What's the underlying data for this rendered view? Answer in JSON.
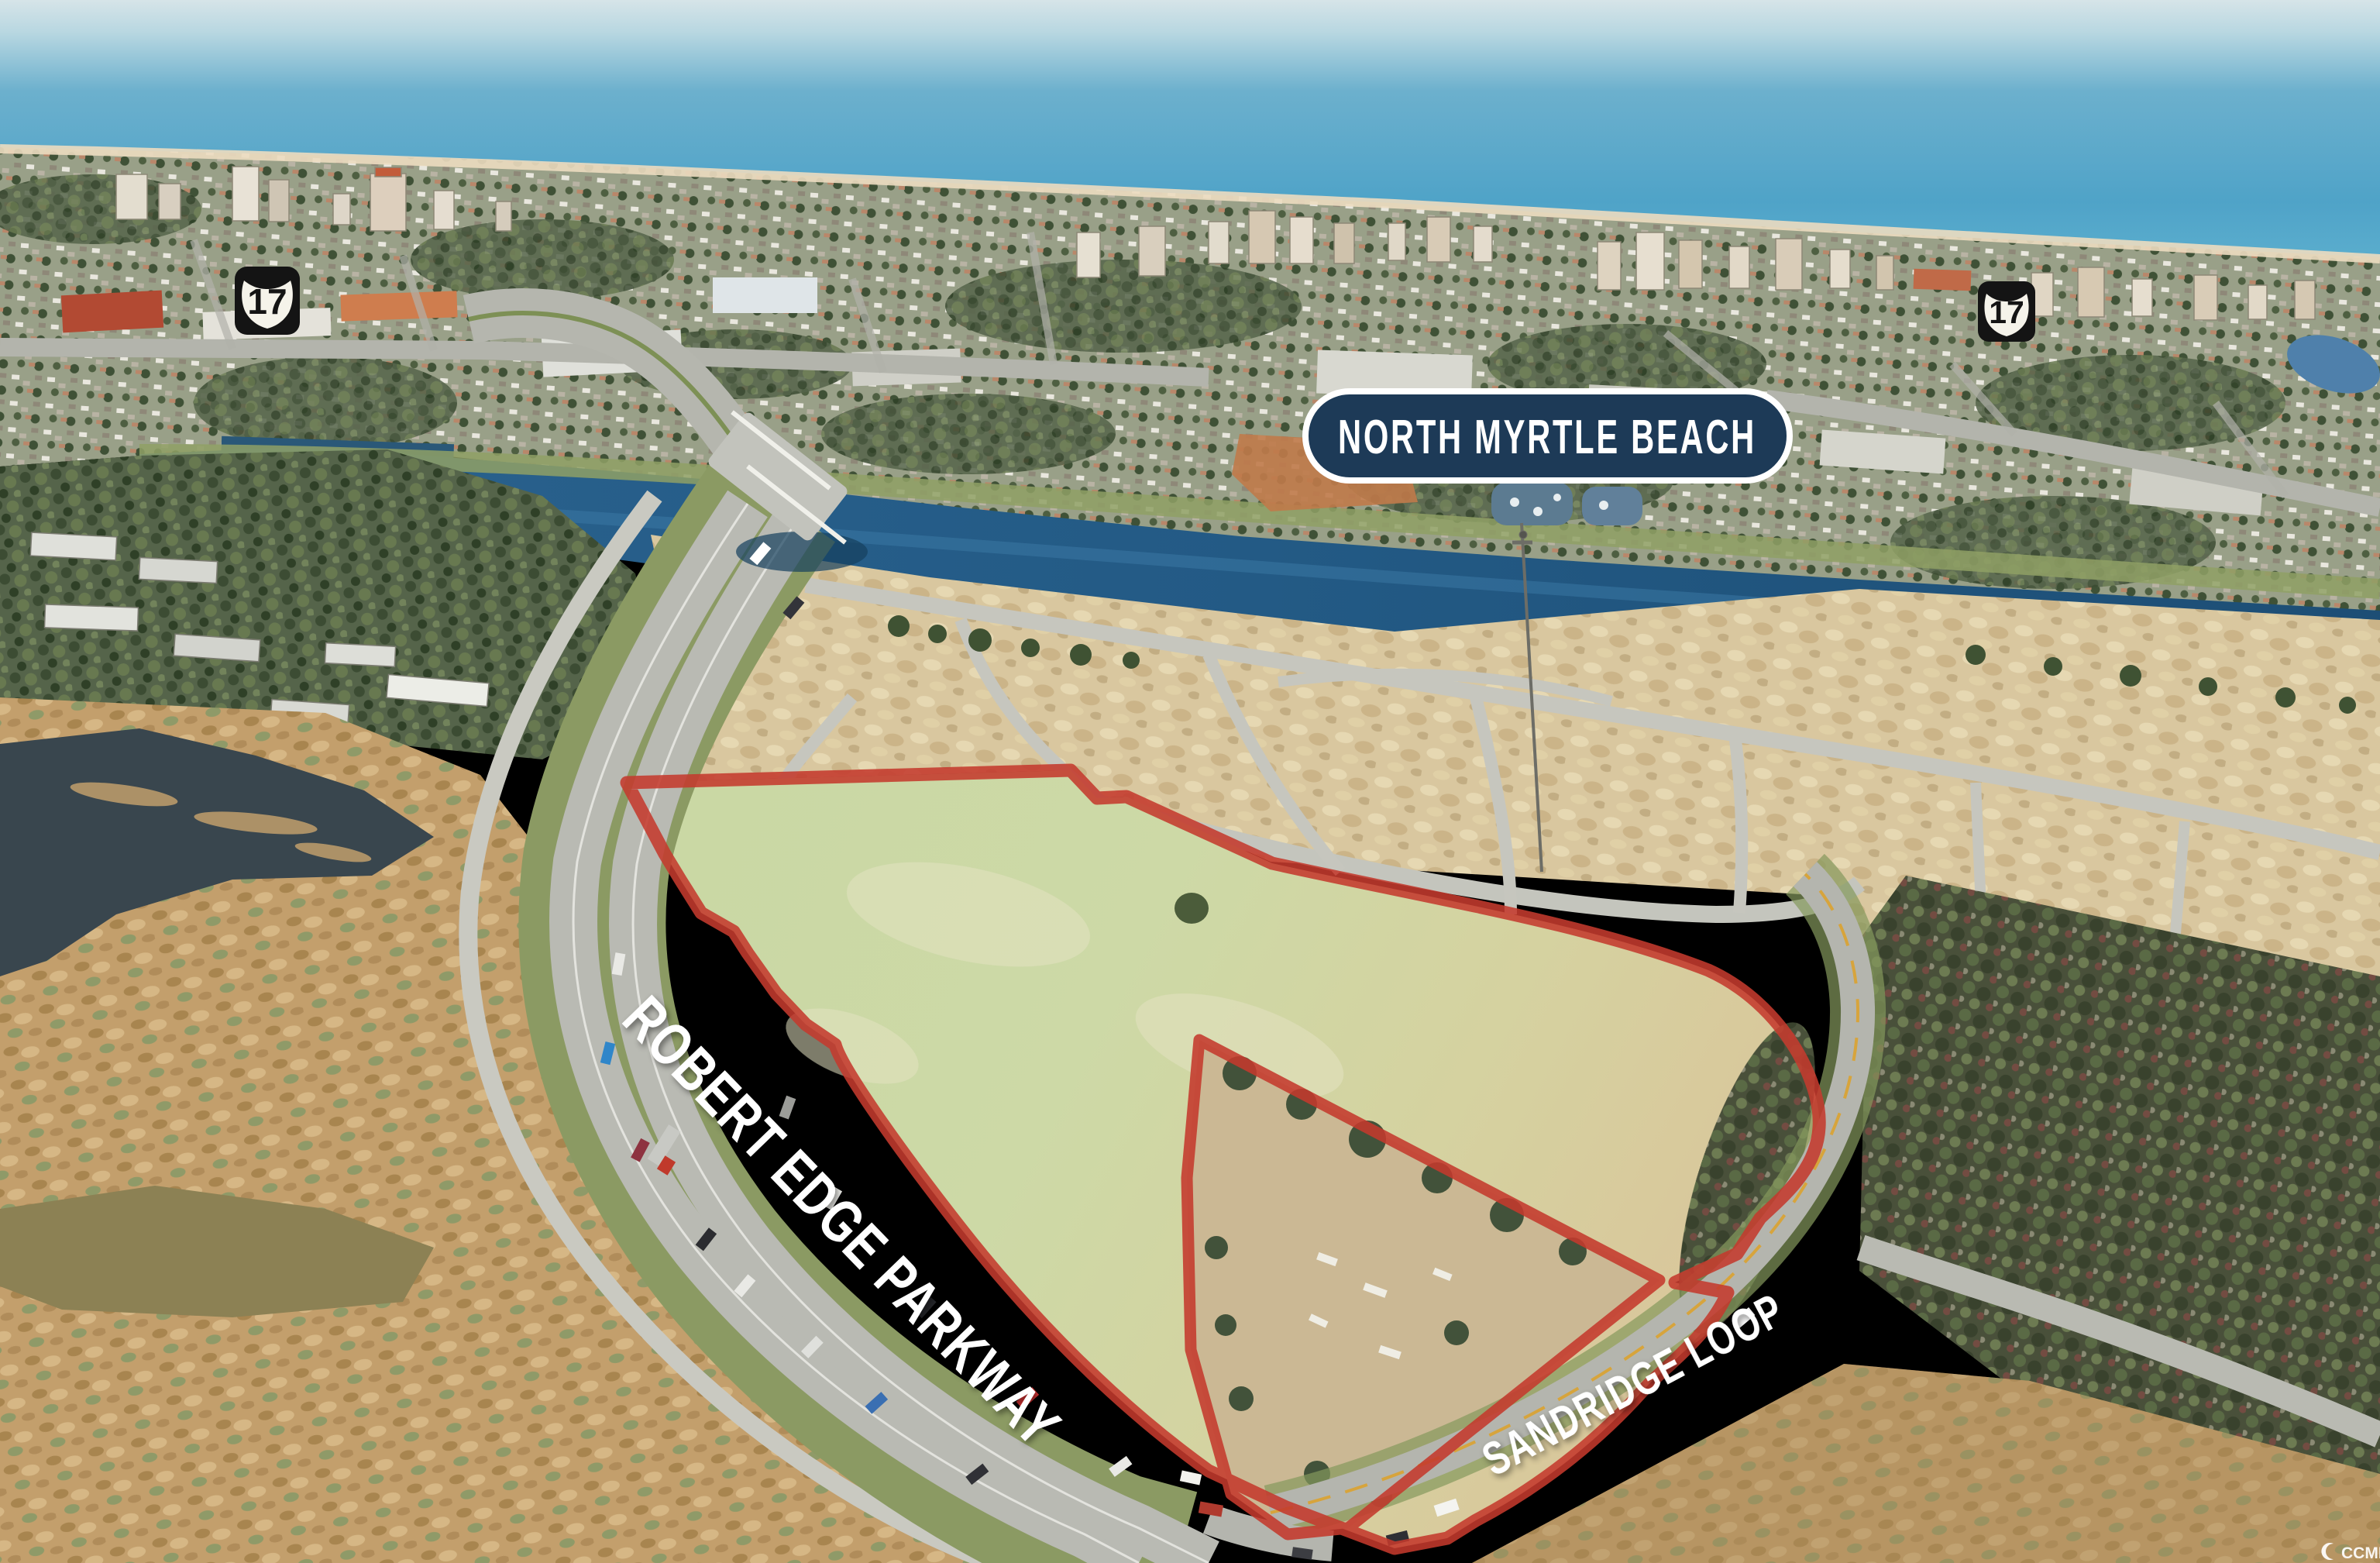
{
  "badge": {
    "label": "NORTH MYRTLE BEACH"
  },
  "route_shields": {
    "number": "17"
  },
  "road_labels": {
    "parkway": "ROBERT EDGE PARKWAY",
    "loop": "SANDRIDGE LOOP"
  },
  "watermark": {
    "text": "CCMLS"
  },
  "colors": {
    "badge_bg": "#1d3a57",
    "badge_border": "#ffffff",
    "boundary_red": "#c43a2d",
    "ocean_deep": "#4fa3c8",
    "waterway": "#235a85",
    "field_green": "#c9d8a4",
    "sand": "#d9c79f"
  }
}
